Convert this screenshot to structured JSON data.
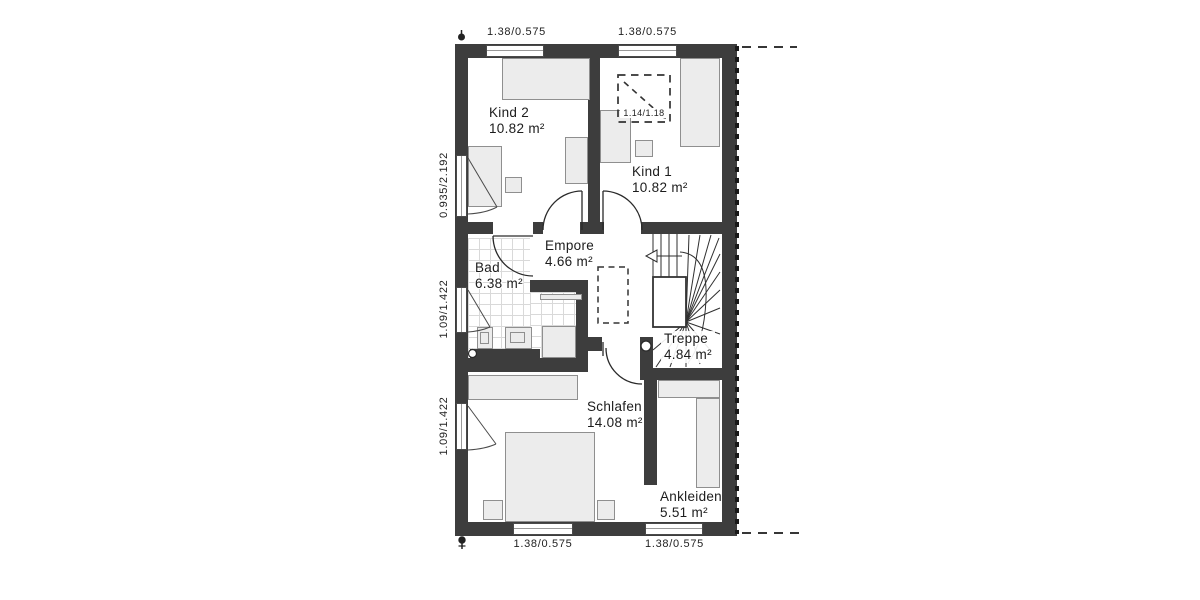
{
  "rooms": [
    {
      "id": "kind2",
      "name": "Kind 2",
      "area": "10.82 m²"
    },
    {
      "id": "kind1",
      "name": "Kind 1",
      "area": "10.82 m²"
    },
    {
      "id": "empore",
      "name": "Empore",
      "area": "4.66 m²"
    },
    {
      "id": "bad",
      "name": "Bad",
      "area": "6.38 m²"
    },
    {
      "id": "treppe",
      "name": "Treppe",
      "area": "4.84 m²"
    },
    {
      "id": "schlafen",
      "name": "Schlafen",
      "area": "14.08 m²"
    },
    {
      "id": "ankleiden",
      "name": "Ankleiden",
      "area": "5.51 m²"
    }
  ],
  "dimensions": {
    "top_window_left": "1.38/0.575",
    "top_window_right": "1.38/0.575",
    "left_window_upper": "0.935/2.192",
    "left_window_middle": "1.09/1.422",
    "left_window_lower": "1.09/1.422",
    "bottom_window_left": "1.38/0.575",
    "bottom_window_right": "1.38/0.575",
    "roof_window": "1.14/1.18"
  },
  "colors": {
    "wall": "#3d3d3d",
    "furniture": "#ececec",
    "line": "#333333",
    "tile_grid": "#d9d9d9"
  }
}
